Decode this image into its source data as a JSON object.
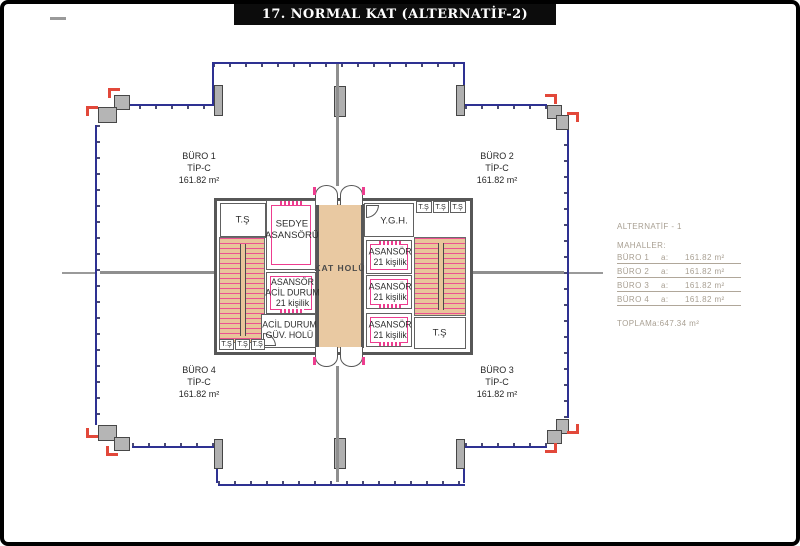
{
  "title": "17. NORMAL KAT (ALTERNATİF-2)",
  "offices": {
    "buro1": {
      "name": "BÜRO 1",
      "type": "TİP-C",
      "area": "161.82 m²"
    },
    "buro2": {
      "name": "BÜRO 2",
      "type": "TİP-C",
      "area": "161.82 m²"
    },
    "buro3": {
      "name": "BÜRO 3",
      "type": "TİP-C",
      "area": "161.82 m²"
    },
    "buro4": {
      "name": "BÜRO 4",
      "type": "TİP-C",
      "area": "161.82 m²"
    }
  },
  "core": {
    "kat_holu": "KAT HOLÜ",
    "sedye_line1": "SEDYE",
    "sedye_line2": "ASANSÖRÜ",
    "asansor": "ASANSÖR",
    "kisilik": "21 kişilik",
    "acil_durum": "ACİL DURUM",
    "guv_holu": "GÜV. HOLÜ",
    "ygh": "Y.G.H.",
    "ts": "T.Ş"
  },
  "legend": {
    "alternatif": "ALTERNATİF - 1",
    "mahaller": "MAHALLER:",
    "rows": [
      {
        "name": "BÜRO 1",
        "key": "a:",
        "value": "161.82 m²"
      },
      {
        "name": "BÜRO 2",
        "key": "a:",
        "value": "161.82 m²"
      },
      {
        "name": "BÜRO 3",
        "key": "a:",
        "value": "161.82 m²"
      },
      {
        "name": "BÜRO 4",
        "key": "a:",
        "value": "161.82 m²"
      }
    ],
    "toplam": {
      "name": "TOPLAM",
      "key": "a:",
      "value": "647.34 m²"
    }
  },
  "colors": {
    "facade_blue": "#2e3192",
    "wall_gray": "#575757",
    "accent_pink": "#ed3d8f",
    "accent_red": "#e2483a",
    "floor_tan": "#e9c9a2",
    "legend_text": "#a89f92"
  }
}
